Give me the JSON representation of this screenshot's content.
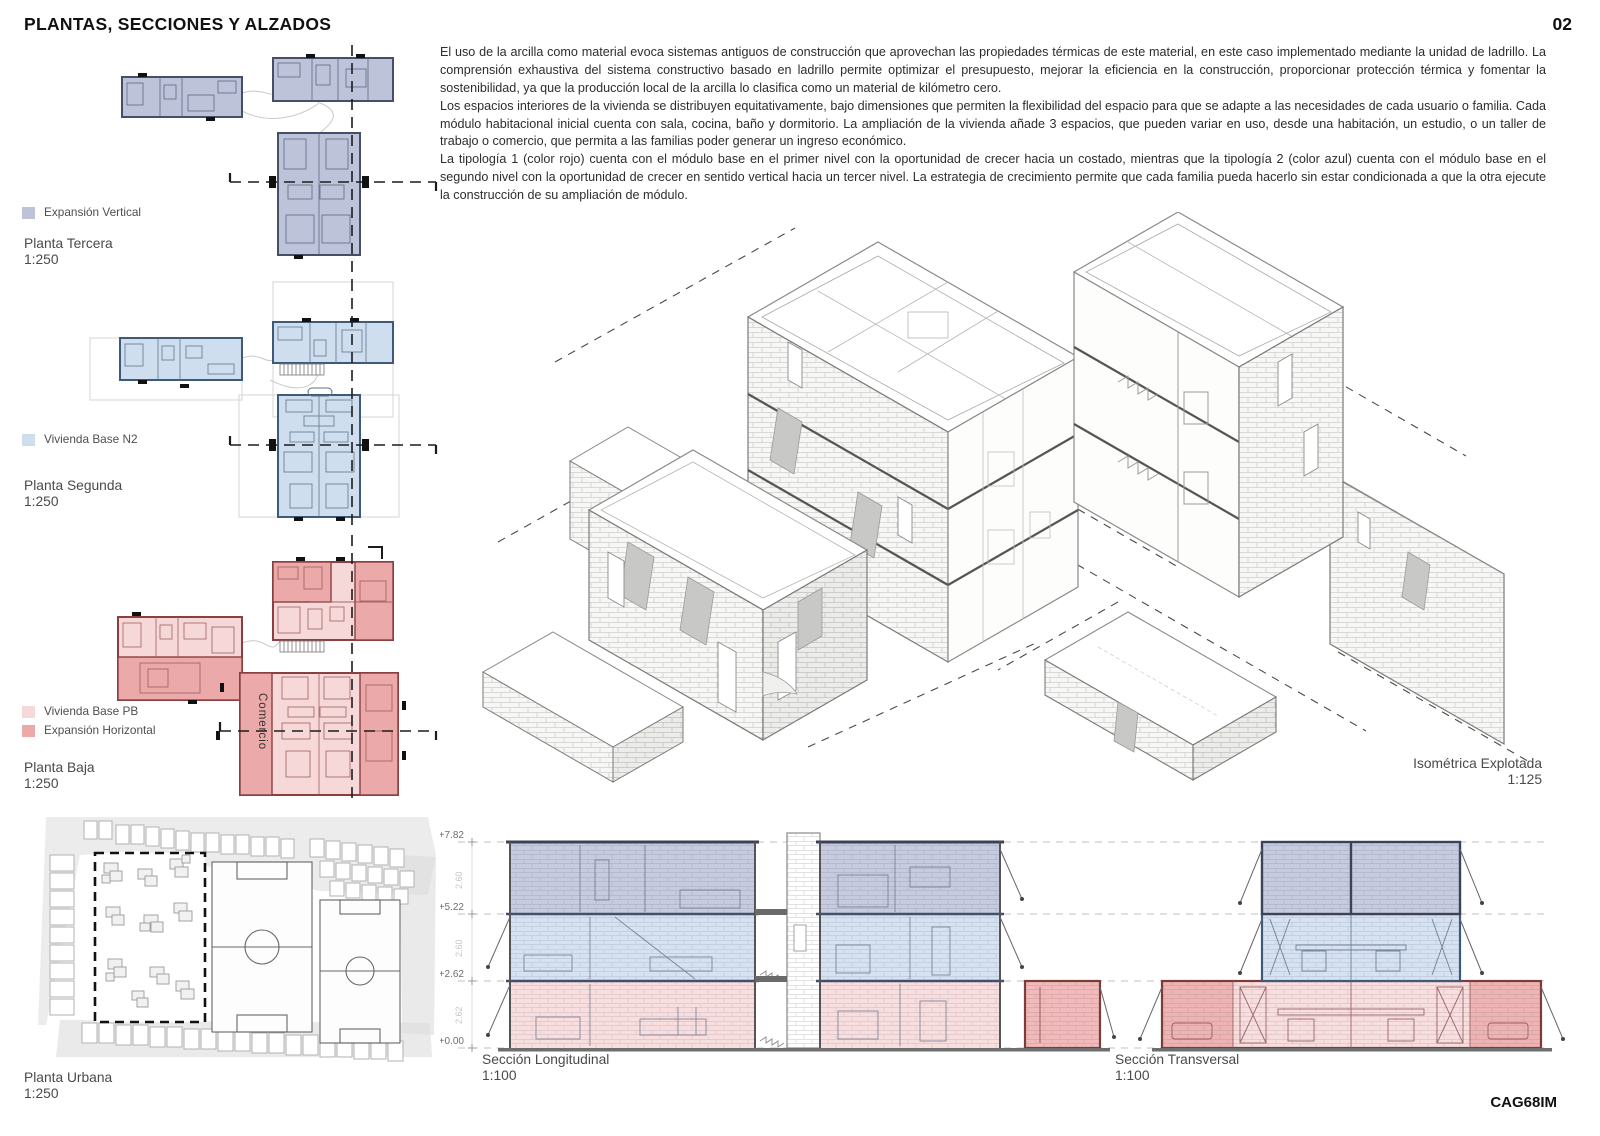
{
  "page": {
    "title": "PLANTAS, SECCIONES Y ALZADOS",
    "page_number": "02",
    "code": "CAG68IM"
  },
  "description": {
    "paragraphs": [
      "El uso de la arcilla como material evoca sistemas antiguos de construcción que aprovechan las propiedades térmicas de este material, en este caso implementado mediante la unidad de ladrillo. La comprensión exhaustiva del sistema constructivo basado en ladrillo permite optimizar el presupuesto, mejorar la eficiencia en la construcción, proporcionar protección térmica y fomentar la sostenibilidad, ya que la producción local de la arcilla lo clasifica como un material de kilómetro cero.",
      "Los espacios interiores de la vivienda se distribuyen equitativamente, bajo dimensiones que permiten la flexibilidad del espacio para que se adapte a las necesidades de cada usuario o familia. Cada módulo habitacional inicial cuenta con sala, cocina, baño y dormitorio. La ampliación de la vivienda añade 3 espacios, que pueden variar en uso, desde una habitación, un estudio, o un taller de trabajo o comercio, que permita a las familias poder generar un ingreso económico.",
      "La tipología 1 (color rojo) cuenta con el módulo base en el primer nivel con la oportunidad de crecer hacia un costado, mientras que la tipología 2 (color azul) cuenta con el módulo base en el segundo nivel con la oportunidad de crecer en sentido vertical hacia un tercer nivel. La estrategia de crecimiento permite que cada familia pueda hacerlo sin estar condicionada a que la otra ejecute la construcción de su ampliación de módulo."
    ]
  },
  "legend": {
    "expansion_vertical": "Expansión Vertical",
    "vivienda_base_n2": "Vivienda Base N2",
    "vivienda_base_pb": "Vivienda Base PB",
    "expansion_horizontal": "Expansión Horizontal"
  },
  "panels": {
    "tercera": {
      "title": "Planta Tercera",
      "scale": "1:250"
    },
    "segunda": {
      "title": "Planta Segunda",
      "scale": "1:250"
    },
    "baja": {
      "title": "Planta Baja",
      "scale": "1:250"
    },
    "urbana": {
      "title": "Planta Urbana",
      "scale": "1:250"
    },
    "isometrica": {
      "title": "Isométrica Explotada",
      "scale": "1:125"
    },
    "longitudinal": {
      "title": "Sección Longitudinal",
      "scale": "1:100"
    },
    "transversal": {
      "title": "Sección Transversal",
      "scale": "1:100"
    }
  },
  "sections": {
    "levels": [
      "+7.82",
      "+5.22",
      "+2.62",
      "+0.00"
    ],
    "floor_heights": [
      "2.60",
      "2.60",
      "2.62"
    ]
  },
  "annotations": {
    "comercio": "Comercio"
  },
  "colors": {
    "expansion_vertical": "#bdc4da",
    "vivienda_base_n2": "#cfdeee",
    "vivienda_base_pb": "#f6d8d8",
    "expansion_horizontal": "#eba9a9",
    "section_level_1": "#c7cbdf",
    "section_level_2": "#d6e2f1",
    "section_level_3": "#f8dede",
    "ink": "#111111"
  }
}
